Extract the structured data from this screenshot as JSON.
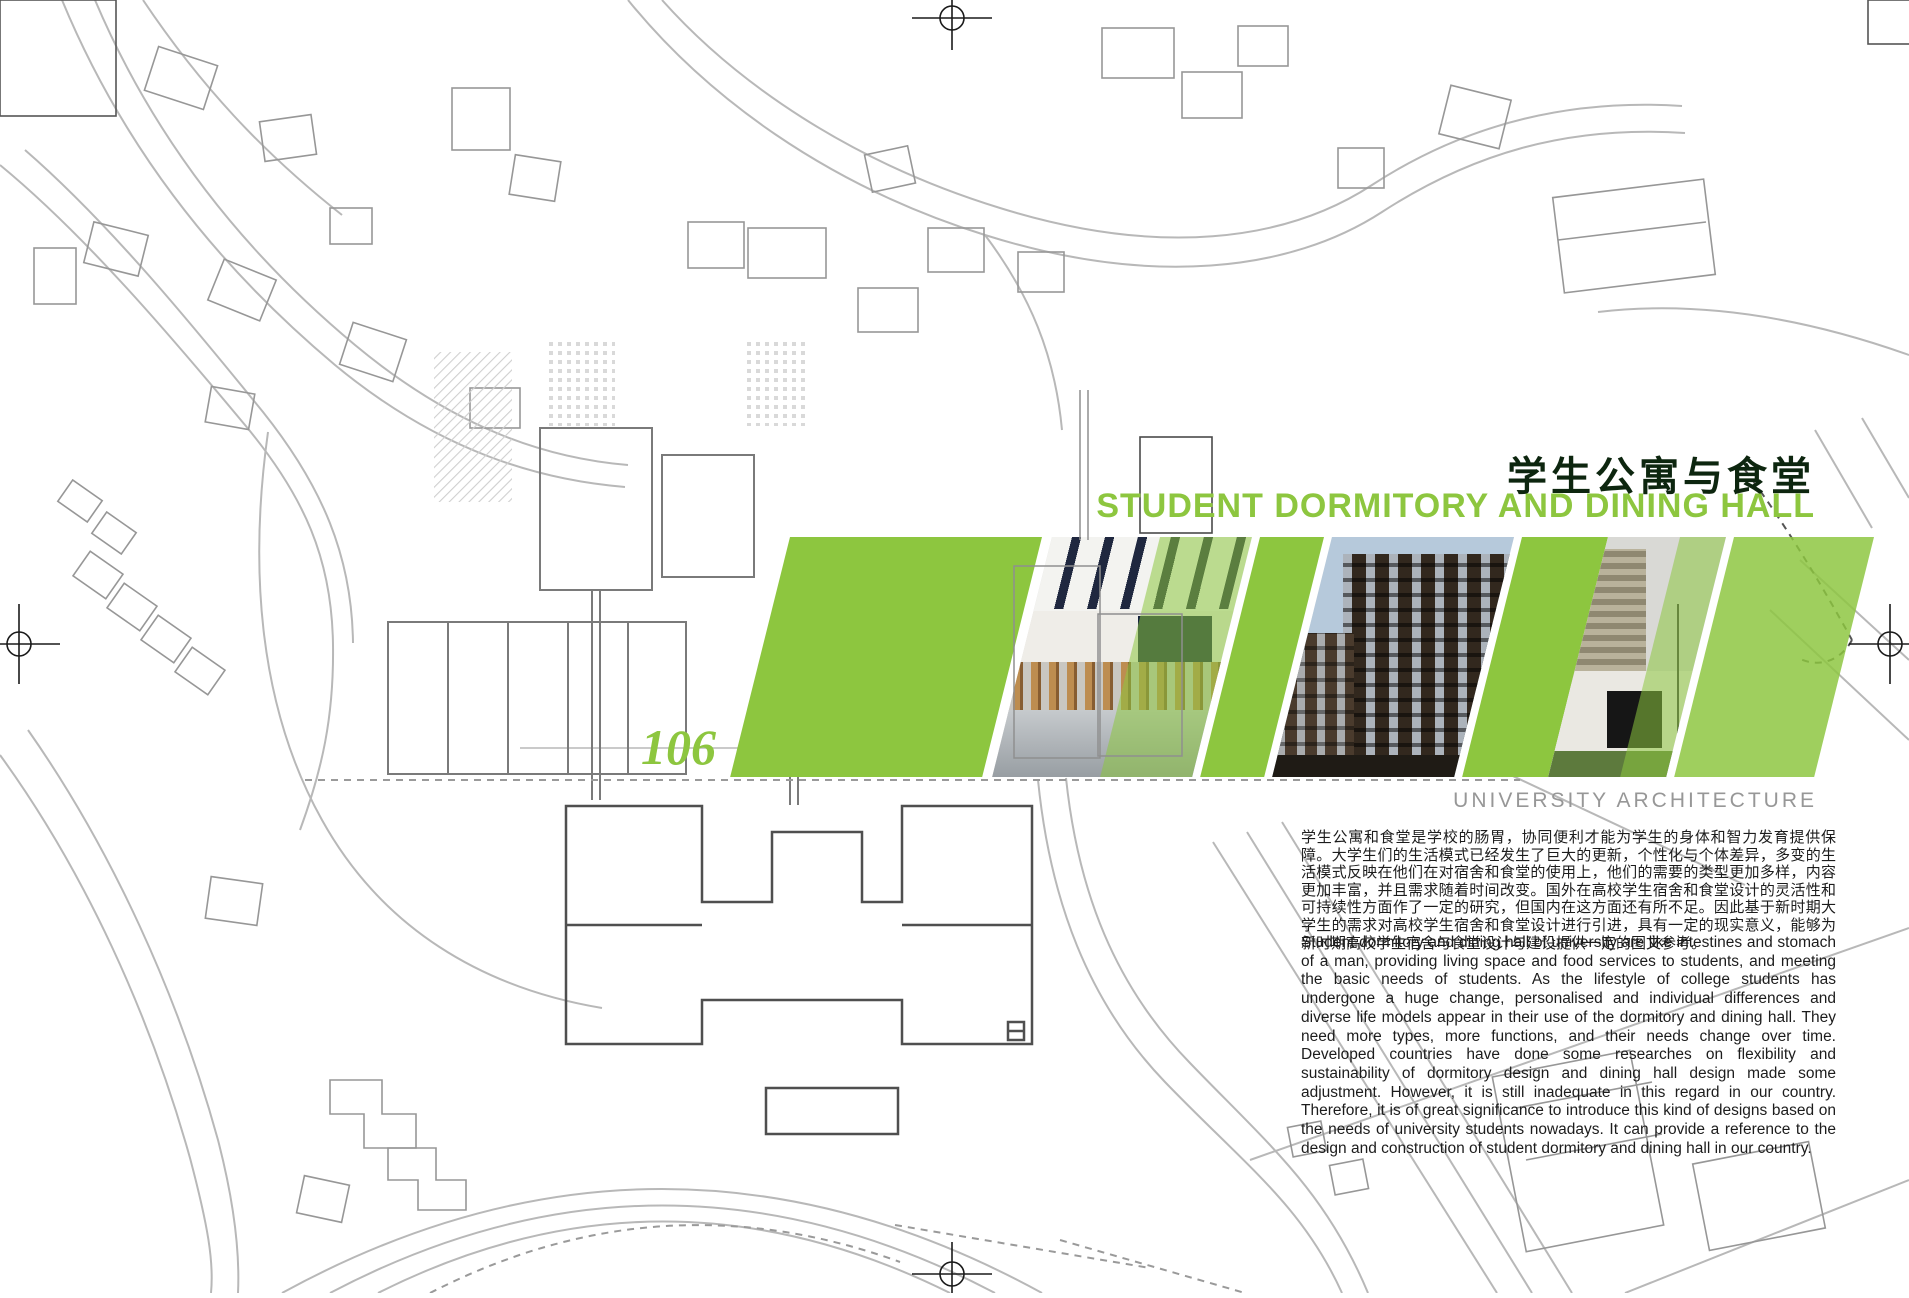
{
  "page": {
    "number": "106",
    "category_label": "UNIVERSITY ARCHITECTURE",
    "title_zh": "学生公寓与食堂",
    "title_en": "STUDENT DORMITORY AND DINING HALL",
    "intro_zh": "学生公寓和食堂是学校的肠胃，协同便利才能为学生的身体和智力发育提供保障。大学生们的生活模式已经发生了巨大的更新，个性化与个体差异，多变的生活模式反映在他们在对宿舍和食堂的使用上，他们的需要的类型更加多样，内容更加丰富，并且需求随着时间改变。国外在高校学生宿舍和食堂设计的灵活性和可持续性方面作了一定的研究，但国内在这方面还有所不足。因此基于新时期大学生的需求对高校学生宿舍和食堂设计进行引进，具有一定的现实意义，能够为新时期高校学生宿舍与食堂设计与建设提供一定的图文参考。",
    "intro_en": "Student dormitory and dining hall of university are like intestines and stomach of a man, providing living space and food services to students, and meeting the basic needs of students. As the lifestyle of college students has undergone a huge change, personalised and individual differences and diverse life models appear in their use of the dormitory and dining hall. They need more types, more functions, and their needs change over time. Developed countries have done some researches on flexibility and sustainability of dormitory design and dining hall design made some adjustment. However, it is still inadequate in this regard in our country. Therefore, it is of great significance to introduce this kind of designs based on the needs of university students nowadays. It can provide a reference to the design and construction of student dormitory and dining hall in our country."
  },
  "banner": {
    "accent_green": "#8dc63f",
    "photos": [
      {
        "name": "dining-hall-interior"
      },
      {
        "name": "dormitory-brick-facade"
      },
      {
        "name": "dining-hall-exterior"
      }
    ]
  },
  "marks": {
    "registration": "circle-crosshair"
  },
  "colors": {
    "title_zh": "#0d260f",
    "title_en": "#8dc63f",
    "page_number": "#8dc63f",
    "category_label": "#979797",
    "body_text": "#1c1c1c",
    "map_line": "#a8a8a8"
  }
}
